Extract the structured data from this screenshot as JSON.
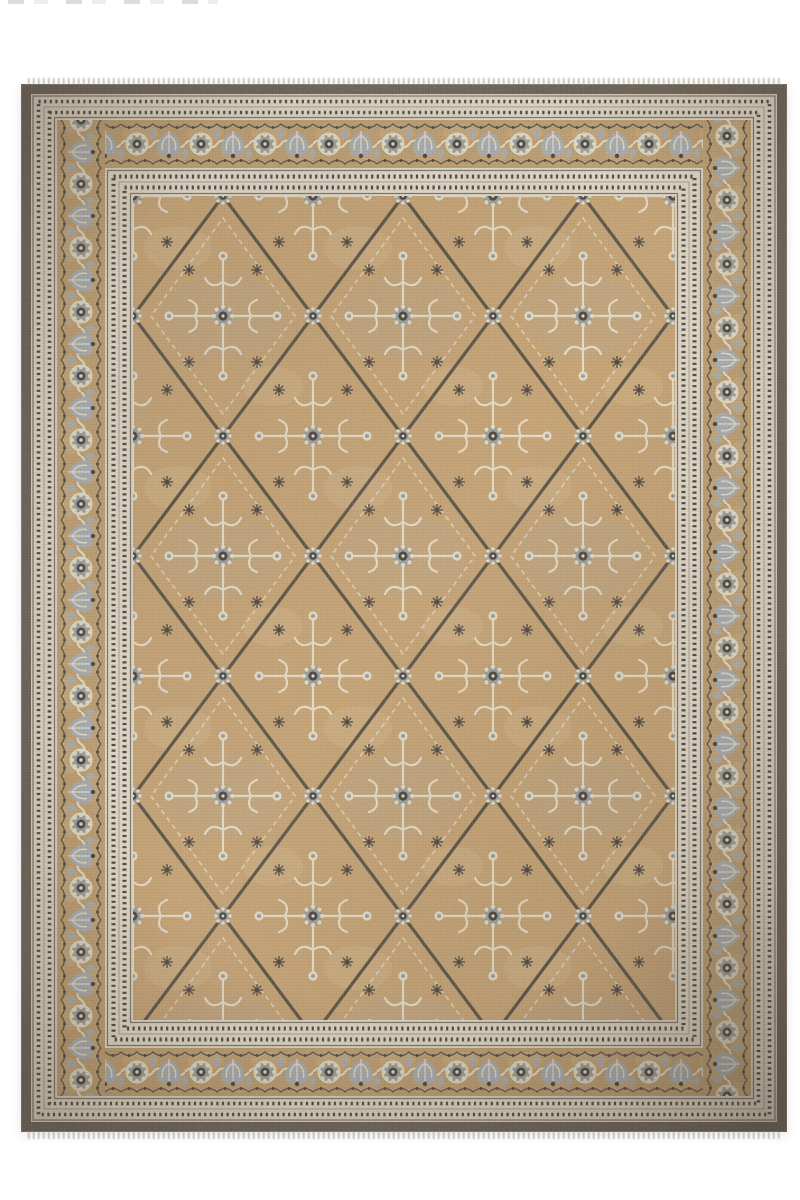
{
  "image": {
    "type": "product-photograph",
    "subject": "hand-knotted oriental area rug, rectangular, photographed flat from above on a white backdrop",
    "alt": "Vintage-style oriental rug with a taupe-gold field covered by an all-over diamond trellis of charcoal vines, grey-blue and cream rosettes and floral sprigs, framed by striped guard bands and a wide camel main border of alternating rosettes and palmettes inside a dark charcoal-brown outer band with short fringe at top and bottom",
    "orientation": "portrait"
  },
  "rug": {
    "field_motif": "diamond trellis lattice with rosettes and radiating floral clusters",
    "main_border_motif": "alternating round rosettes and fan palmettes linked by a scrolling cream vine with scalloped edge rows",
    "guard_motif": "cream bands with fine charcoal pinstripes and beaded dot rows",
    "bands_outside_in": [
      "white backdrop",
      "short knotted fringe (top and bottom edges)",
      "dark charcoal-brown outer band",
      "striped outer guard band",
      "camel main border with rosettes and palmettes",
      "striped inner guard band",
      "taupe-gold trellis field"
    ],
    "condition_look": "distressed low-pile wash with abrash mottling"
  },
  "colors": {
    "page-bg": "#ffffff",
    "band-dark": "#6d6459",
    "guard-cream": "#e2dac9",
    "guard-line": "#7e756b",
    "guard-dot": "#4e4841",
    "border-tan": "#bfa073",
    "rosette-grey": "#9ba09f",
    "rosette-dark": "#4c453d",
    "cream": "#e6ddc8",
    "leaf-blue": "#a9afb3",
    "vine-dark": "#5e564b",
    "field-tan": "#c6a476",
    "field-light": "#d8c29a",
    "lattice": "#5d5549",
    "fringe": "#b3ac9e"
  }
}
